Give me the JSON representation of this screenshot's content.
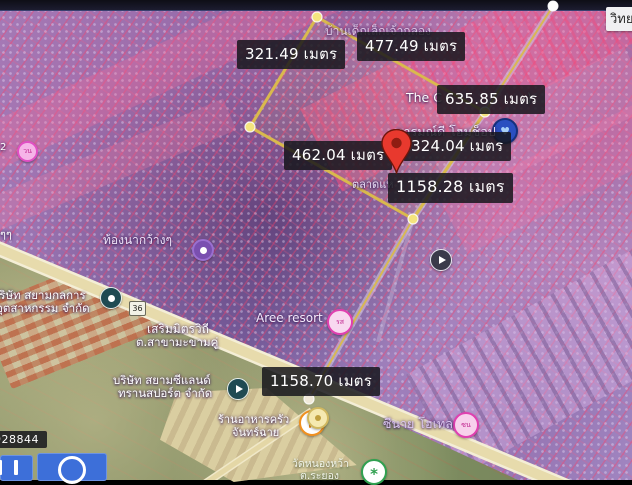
{
  "app": {
    "description_note": "satellite map with land-plot purple overlay and distance measurements"
  },
  "colors": {
    "measure_line": "#d9b94d",
    "vertex_dot": "#f4e47e",
    "label_bg": "rgba(22,22,28,0.85)",
    "label_text": "#ffffff",
    "overlay_purple": "#8a6fae",
    "road_tan": "#e6d9a9",
    "pin_red": "#e8392e",
    "button_blue": "#3d6fd9"
  },
  "measurements": {
    "top_left": "321.49 เมตร",
    "top_right": "477.49 เมตร",
    "mid_right": "635.85 เมตร",
    "mid_left": "462.04 เมตร",
    "mid_center": "324.04 เมตร",
    "long_upper": "1158.28 เมตร",
    "long_lower": "1158.70 เมตร"
  },
  "corner_label": {
    "text": "วิทย"
  },
  "ref_code": {
    "text": "928844"
  },
  "places": {
    "nursery": "บ้านเด็กเล็กเจ้ากลอง",
    "the_c": "The C",
    "the_c_paren": ")",
    "arom_dee": "อารมณ์ดี โฮมช็อป",
    "talad": "ตลาดแห",
    "tong_na": "ท้องนากว้างๆ",
    "siam_kolkan_1": "บริษัท สยามกลการ",
    "siam_kolkan_2": "อุตสาหกรรม จำกัด",
    "serm_mit": "เสริมมิตรวิถี",
    "makham_khu": "ต.สาขามะขามคู่",
    "aree_resort": "Aree resort",
    "siam_sealand_1": "บริษัท สยามซีแลนด์",
    "siam_sealand_2": "ทรานสปอร์ต จำกัด",
    "krua_1": "ร้านอาหารครัว",
    "krua_2": "จันทร์ฉาย",
    "sinai_hotel": "ซีนาย โฮเทล",
    "wat_1": "วัดหนองหว้า",
    "wat_2": "ต.ระยอง",
    "route_shield": "36",
    "edge_left_top": "2",
    "edge_left_mid": "ๆๆ"
  }
}
